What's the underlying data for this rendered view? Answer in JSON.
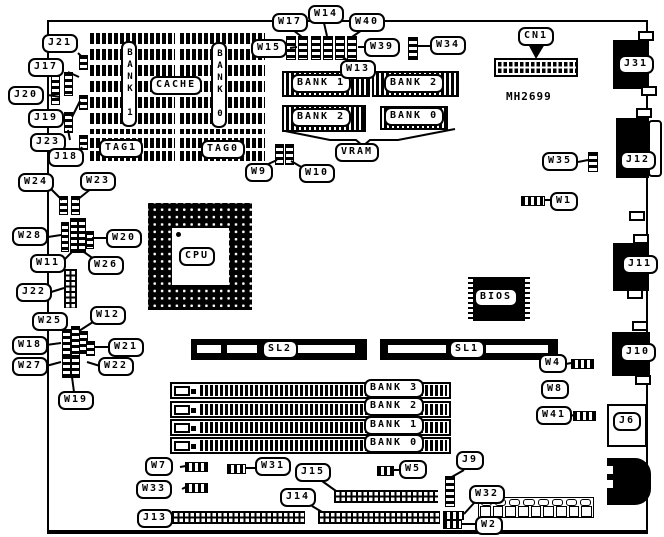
{
  "board": {
    "model": "MH2699"
  },
  "callouts": {
    "j21": "J21",
    "j17": "J17",
    "j20": "J20",
    "j19": "J19",
    "j23": "J23",
    "j18": "J18",
    "w24": "W24",
    "w23": "W23",
    "w28": "W28",
    "w20": "W20",
    "w11": "W11",
    "w26": "W26",
    "j22": "J22",
    "w25": "W25",
    "w12": "W12",
    "w18": "W18",
    "w21": "W21",
    "w27": "W27",
    "w22": "W22",
    "w19": "W19",
    "w17": "W17",
    "w14": "W14",
    "w40": "W40",
    "w15": "W15",
    "w39": "W39",
    "w34": "W34",
    "w13": "W13",
    "w9": "W9",
    "w10": "W10",
    "cn1": "CN1",
    "j31": "J31",
    "w35": "W35",
    "w1": "W1",
    "j12": "J12",
    "j11": "J11",
    "j10": "J10",
    "w4": "W4",
    "w8": "W8",
    "w41": "W41",
    "j6": "J6",
    "w7": "W7",
    "w31": "W31",
    "j15": "J15",
    "w5": "W5",
    "j9": "J9",
    "w33": "W33",
    "j14": "J14",
    "w32": "W32",
    "j13": "J13",
    "w2": "W2"
  },
  "components": {
    "cache_title": "CACHE",
    "cache_bank1": "BANK 1",
    "cache_bank0": "BANK 0",
    "tag1": "TAG1",
    "tag0": "TAG0",
    "vram_title": "VRAM",
    "vram_bank1": "BANK 1",
    "vram_bank2_top": "BANK 2",
    "vram_bank2_bottom": "BANK 2",
    "vram_bank0": "BANK 0",
    "cpu": "CPU",
    "bios": "BIOS",
    "slot_sl2": "SL2",
    "slot_sl1": "SL1",
    "simm_bank3": "BANK 3",
    "simm_bank2": "BANK 2",
    "simm_bank1": "BANK 1",
    "simm_bank0": "BANK 0"
  }
}
